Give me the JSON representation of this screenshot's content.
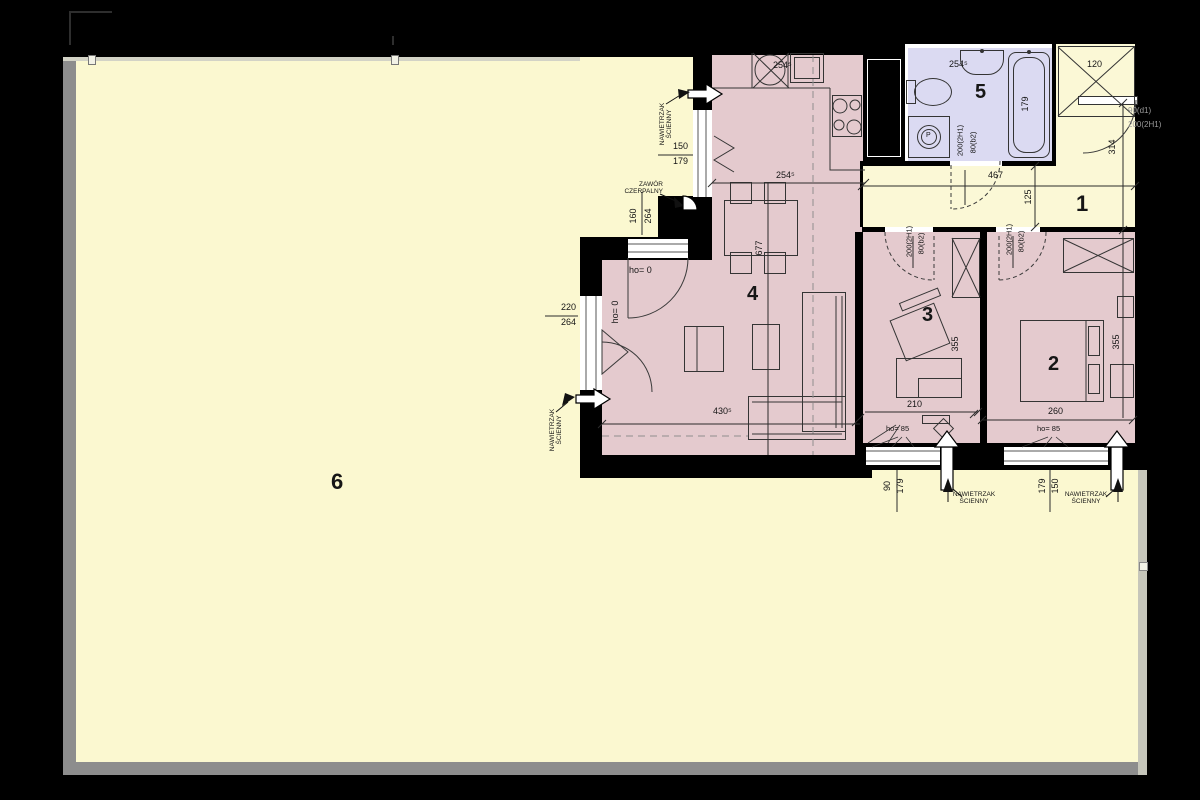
{
  "canvas": {
    "w": 1200,
    "h": 800
  },
  "colors": {
    "bg": "#000000",
    "terrace": "#FBF8D0",
    "pink": "#E4CACE",
    "bath": "#DBDAF2",
    "hall": "#FBF8D6",
    "wall": "#000000",
    "bal": "#8d8d8d",
    "ball": "#c6c6ba",
    "ln": "#2b2b2b"
  },
  "rooms": {
    "r1": "1",
    "r2": "2",
    "r3": "3",
    "r4": "4",
    "r5": "5",
    "r6": "6"
  },
  "annotations": {
    "wall_vent": "NAWIETRZAK\nŚCIENNY",
    "tap_valve": "ZAWÓR\nCZERPALNY",
    "washer_p": "P"
  },
  "dims": {
    "kitchen_depth": "254⁵",
    "bath_sink": "254⁵",
    "hall_width": "467",
    "hall_depth": "125",
    "entry_swing": "314",
    "hall_wardrobe": "120",
    "tub_length": "179",
    "door_width": "80(b2)",
    "door_height": "200(2H1)",
    "entry_width": "90(d1)",
    "entry_height": "200(2H1)",
    "kitchen_window_w": "150",
    "kitchen_window_h": "179",
    "balcony_door_w": "160",
    "balcony_door_h": "264",
    "living_window_w": "220",
    "living_window_h": "264",
    "table_line": "677",
    "living_width": "430⁵",
    "room3_depth": "355",
    "room3_width": "210",
    "room2_depth": "355",
    "room2_width": "260",
    "window_a_w": "90",
    "window_a_h": "179",
    "window_b_w": "150",
    "window_b_h": "179",
    "sill_zero": "ho= 0",
    "sill_85": "ho= 85"
  }
}
